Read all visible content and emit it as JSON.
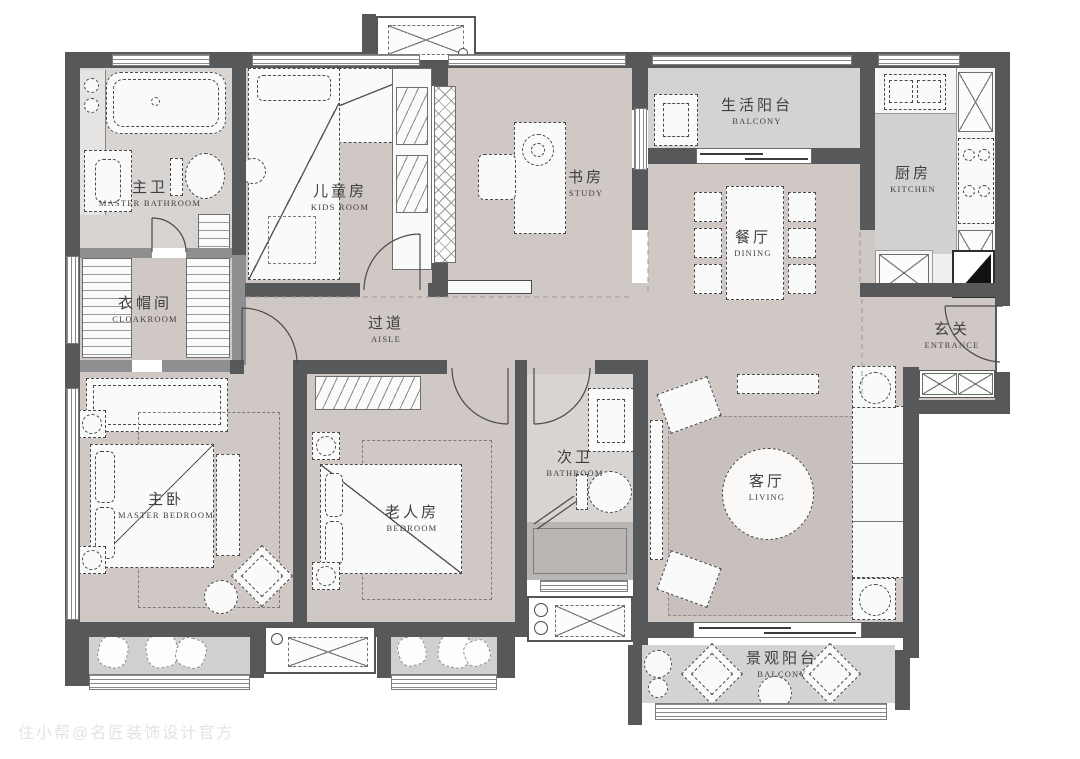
{
  "watermark": "住小帮@名匠装饰设计官方",
  "colors": {
    "wall": "#57585a",
    "wall_light": "#8f8f91",
    "floor_room": "#cfc8c5",
    "floor_wet": "#d7d4d2",
    "floor_balcony": "#d5d3d1",
    "floor_shower": "#b9b6b3",
    "floor_kitchen": "#f1efee",
    "rug_living": "#c7c0bc",
    "furniture": "#fbfafa",
    "line": "#4a4a4a",
    "watermark": "#e5e3e2"
  },
  "rooms": [
    {
      "id": "master-bathroom",
      "zh": "主卫",
      "en": "MASTER BATHROOM"
    },
    {
      "id": "cloakroom",
      "zh": "衣帽间",
      "en": "CLOAKROOM"
    },
    {
      "id": "kids-room",
      "zh": "儿童房",
      "en": "KIDS ROOM"
    },
    {
      "id": "study",
      "zh": "书房",
      "en": "STUDY"
    },
    {
      "id": "life-balcony",
      "zh": "生活阳台",
      "en": "BALCONY"
    },
    {
      "id": "kitchen",
      "zh": "厨房",
      "en": "KITCHEN"
    },
    {
      "id": "dining",
      "zh": "餐厅",
      "en": "DINING"
    },
    {
      "id": "entrance",
      "zh": "玄关",
      "en": "ENTRANCE"
    },
    {
      "id": "aisle",
      "zh": "过道",
      "en": "AISLE"
    },
    {
      "id": "second-bathroom",
      "zh": "次卫",
      "en": "BATHROOM"
    },
    {
      "id": "master-bedroom",
      "zh": "主卧",
      "en": "MASTER BEDROOM"
    },
    {
      "id": "elder-bedroom",
      "zh": "老人房",
      "en": "BEDROOM"
    },
    {
      "id": "living",
      "zh": "客厅",
      "en": "LIVING"
    },
    {
      "id": "view-balcony",
      "zh": "景观阳台",
      "en": "BALCONY"
    }
  ]
}
